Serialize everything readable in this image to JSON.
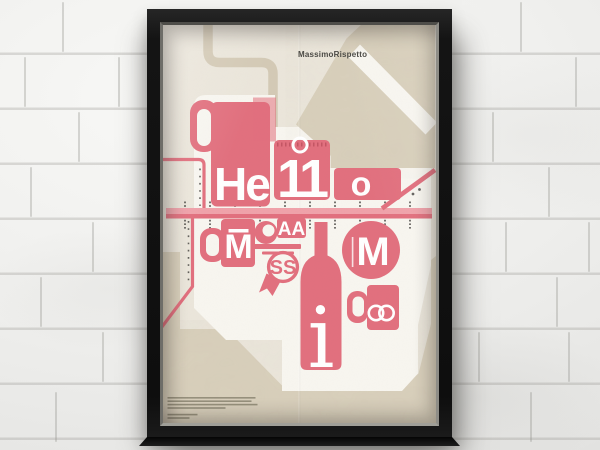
{
  "scene": {
    "setting": "framed poster hanging on a white painted brick wall"
  },
  "poster": {
    "credit": "MassimoRispetto",
    "hello_row": {
      "jug": "He",
      "calendar": "11",
      "tile": "o"
    },
    "massimo_row": {
      "mug": "M",
      "cup": "AA",
      "badge": "SS",
      "bottle": "i",
      "circle": "M"
    },
    "fine_print": {
      "legible": false,
      "line_count": 6
    },
    "colors": {
      "pink": "#e2707e",
      "pink_light": "#f0a2aa",
      "cream": "#ebe6db",
      "beige": "#d9d0bc",
      "tan": "#d4cab6",
      "white": "#f8f6f0",
      "ink": "#4a4944",
      "frame": "#141414"
    }
  }
}
